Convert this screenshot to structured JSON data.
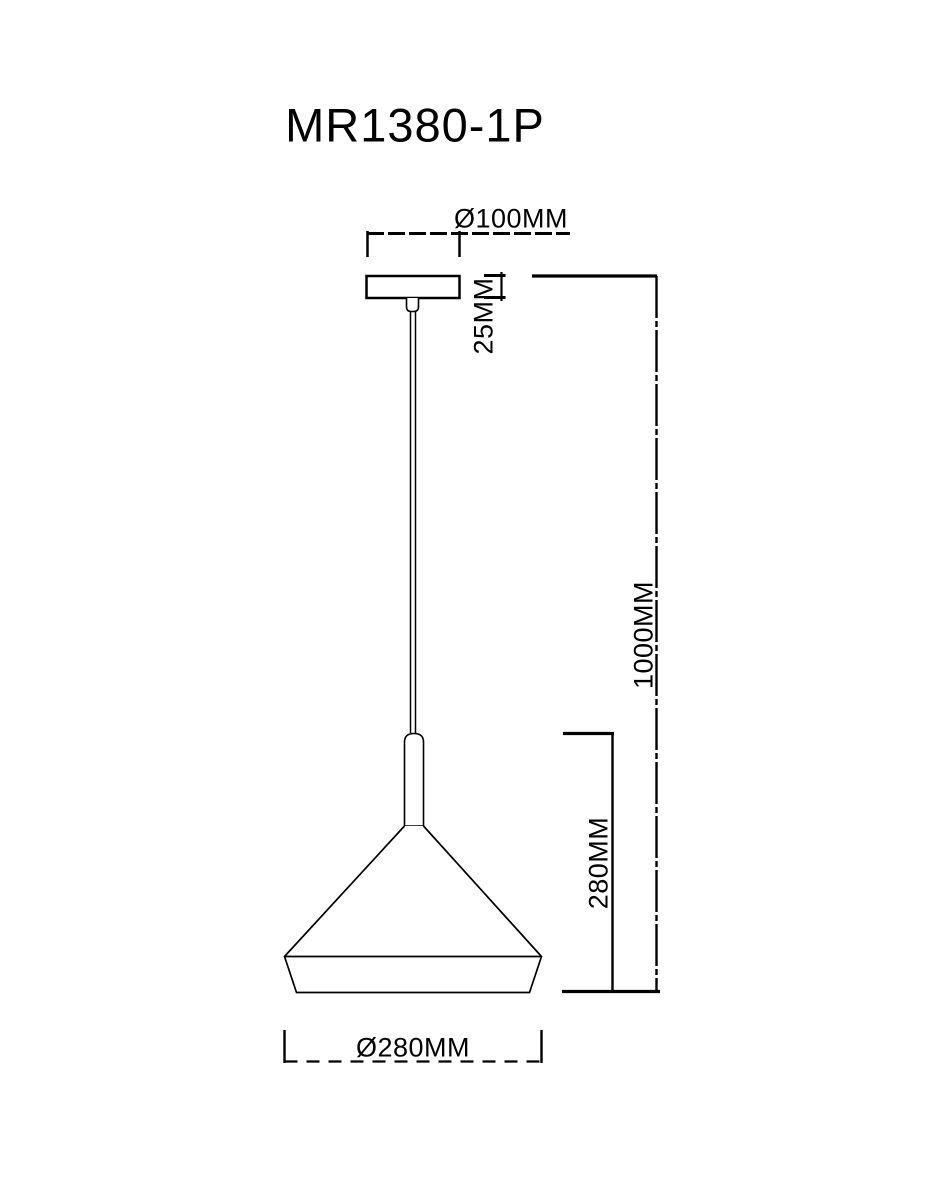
{
  "title": "MR1380-1P",
  "colors": {
    "line": "#000000",
    "background": "#ffffff"
  },
  "dimensions": {
    "canopy_diameter": {
      "label": "Ø100MM",
      "value": 100,
      "unit": "MM"
    },
    "canopy_height": {
      "label": "25MM",
      "value": 25,
      "unit": "MM"
    },
    "overall_height": {
      "label": "1000MM",
      "value": 1000,
      "unit": "MM"
    },
    "shade_height": {
      "label": "280MM",
      "value": 280,
      "unit": "MM"
    },
    "shade_diameter": {
      "label": "Ø280MM",
      "value": 280,
      "unit": "MM"
    }
  }
}
